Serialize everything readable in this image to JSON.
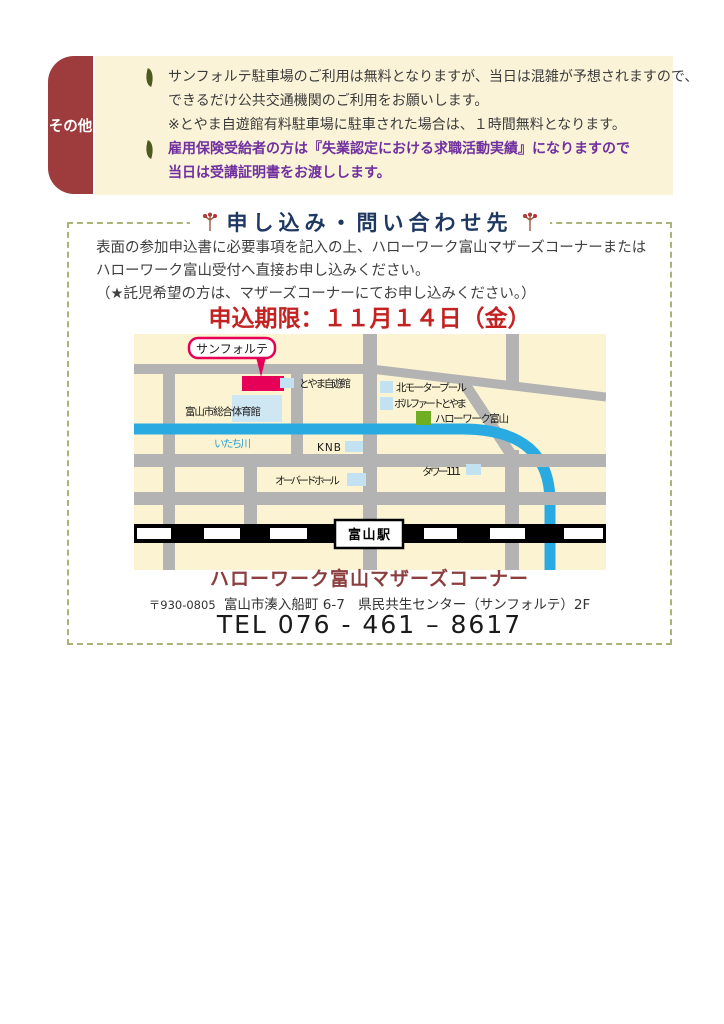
{
  "other_section": {
    "tab_label": "その他",
    "tab_bg": "#9d3b3d",
    "box_bg": "#faf3d8",
    "bullet_icon": "leaf",
    "items": [
      {
        "color": "#3c3c3c",
        "lines": [
          "サンフォルテ駐車場のご利用は無料となりますが、当日は混雑が予想されますので、",
          "できるだけ公共交通機関のご利用をお願いします。",
          "※とやま自遊館有料駐車場に駐車された場合は、１時間無料となります。"
        ]
      },
      {
        "color": "#7030a0",
        "lines": [
          "雇用保険受給者の方は『失業認定における求職活動実績』になりますので",
          "当日は受講証明書をお渡しします。"
        ]
      }
    ]
  },
  "inquiry": {
    "title": "申し込み・問い合わせ先",
    "title_color": "#1e3862",
    "ornament_icon": "flower-sprig",
    "border_color": "#abb478",
    "body_lines": [
      "表面の参加申込書に必要事項を記入の上、ハローワーク富山マザーズコーナーまたは",
      "ハローワーク富山受付へ直接お申し込みください。",
      "（★託児希望の方は、マザーズコーナーにてお申し込みください。）"
    ],
    "deadline": "申込期限：１１月１４日（金）",
    "deadline_color": "#c32222"
  },
  "map": {
    "colors": {
      "background": "#fbf3d1",
      "road": "#b3b3b3",
      "river": "#29abe2",
      "railway": "#000000",
      "building": "#c3e2f1",
      "hellowork_marker": "#6fae22",
      "sanforte_marker": "#e60058"
    },
    "labels": {
      "sanforte": "サンフォルテ",
      "jiyukan": "とやま自遊館",
      "gym": "富山市総合体育館",
      "kita_pool": "北モータープール",
      "bolfart": "ボルファートとやま",
      "hellowork": "ハローワーク富山",
      "itachi_river": "いたち川",
      "knb": "KNB",
      "aubade_hall": "オーバードホール",
      "tower111": "タワー111",
      "station": "富山駅"
    }
  },
  "contact": {
    "name": "ハローワーク富山マザーズコーナー",
    "name_color": "#8c3e3e",
    "postal": "〒930-0805",
    "address": "富山市湊入船町 6-7　県民共生センター（サンフォルテ）2F",
    "tel": "TEL 076 - 461 – 8617"
  }
}
